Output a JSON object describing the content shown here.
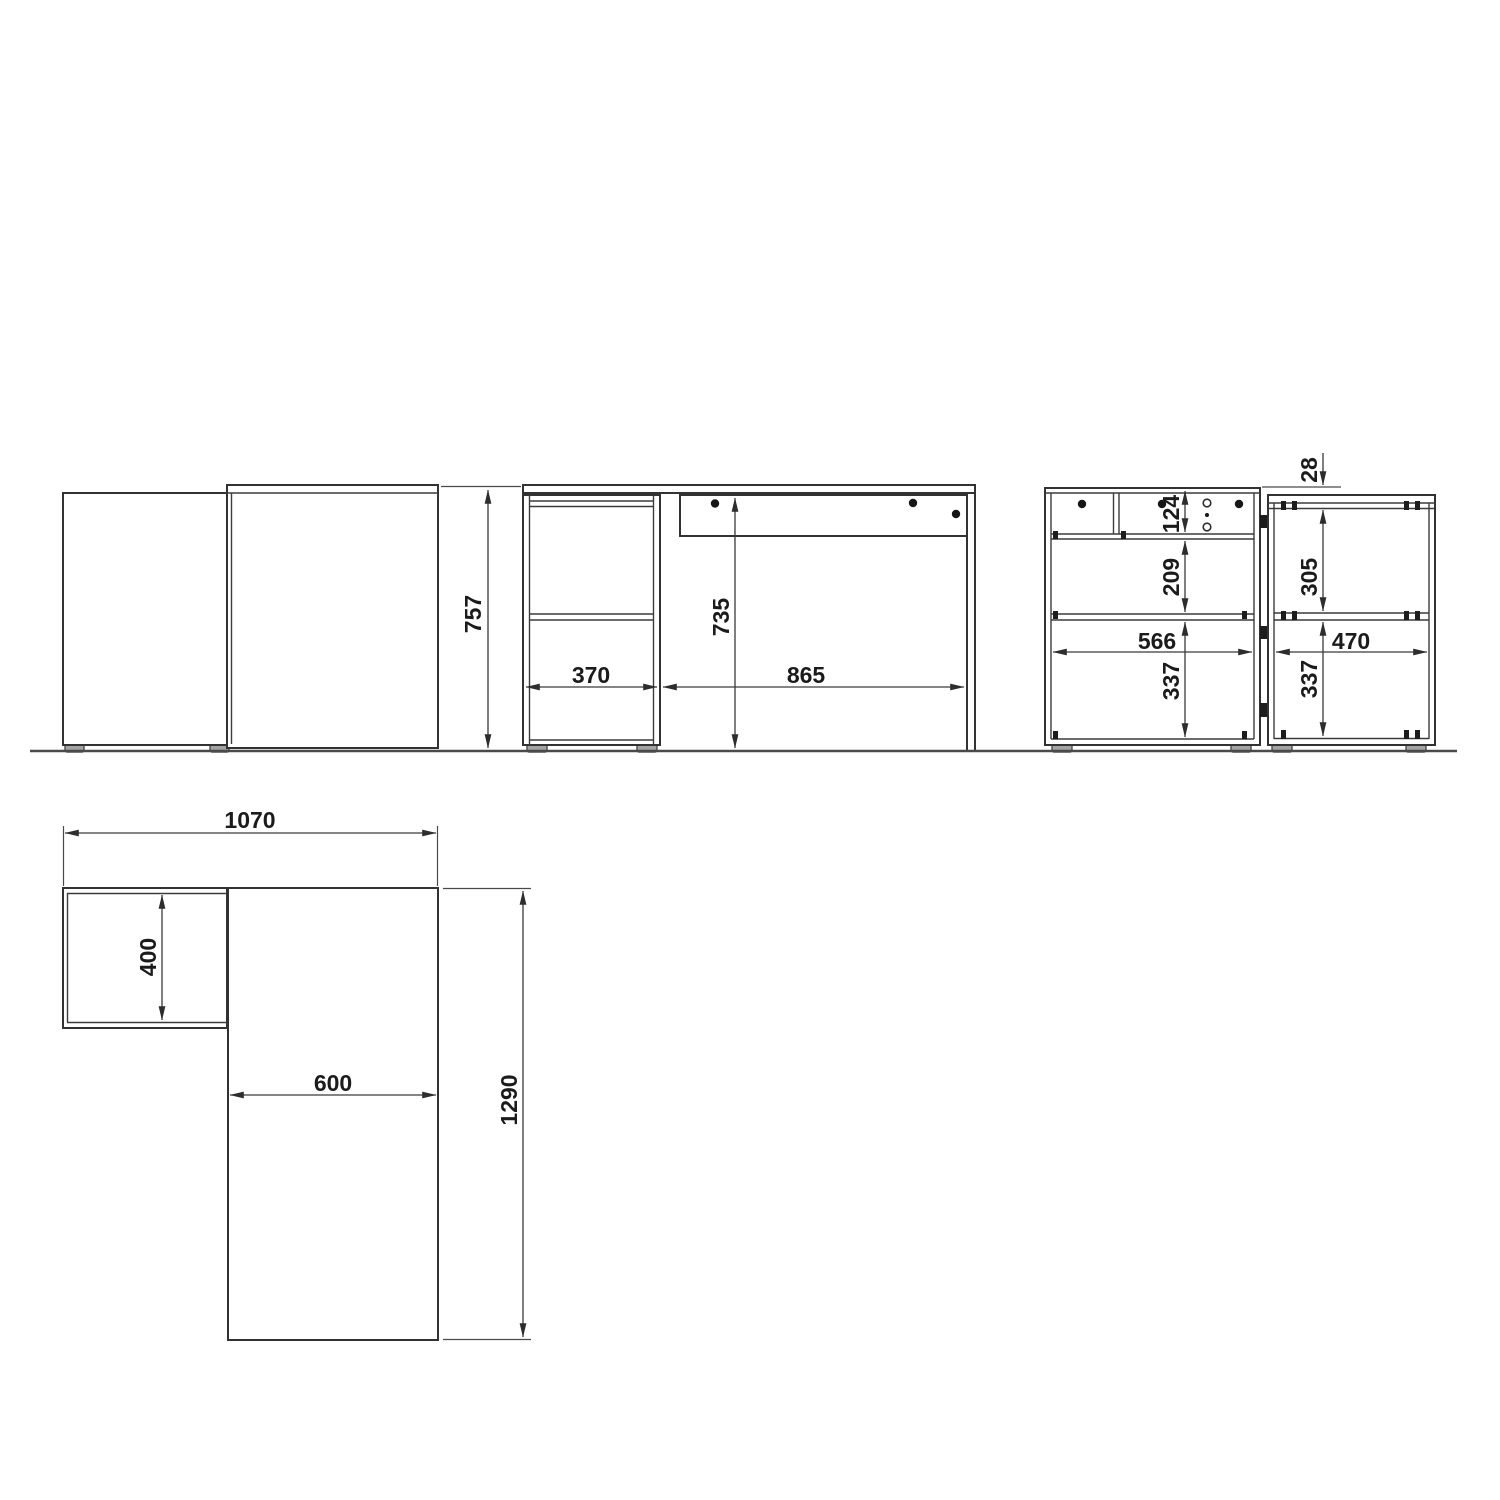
{
  "dimensions": {
    "side_view": {
      "overall_height": "757"
    },
    "front_view": {
      "pedestal_width": "370",
      "clear_inner_height": "735",
      "kneehole_width": "865"
    },
    "back_view_left_cabinet": {
      "drawer_height": "124",
      "open_compartment_height": "209",
      "inner_width": "566",
      "lower_compartment_height": "337"
    },
    "back_view_right_cabinet": {
      "top_panel_offset": "28",
      "upper_compartment_height": "305",
      "inner_width": "470",
      "lower_compartment_height": "337"
    },
    "plan_view": {
      "overall_width": "1070",
      "side_return_depth": "400",
      "desk_depth": "600",
      "overall_length": "1290"
    }
  }
}
